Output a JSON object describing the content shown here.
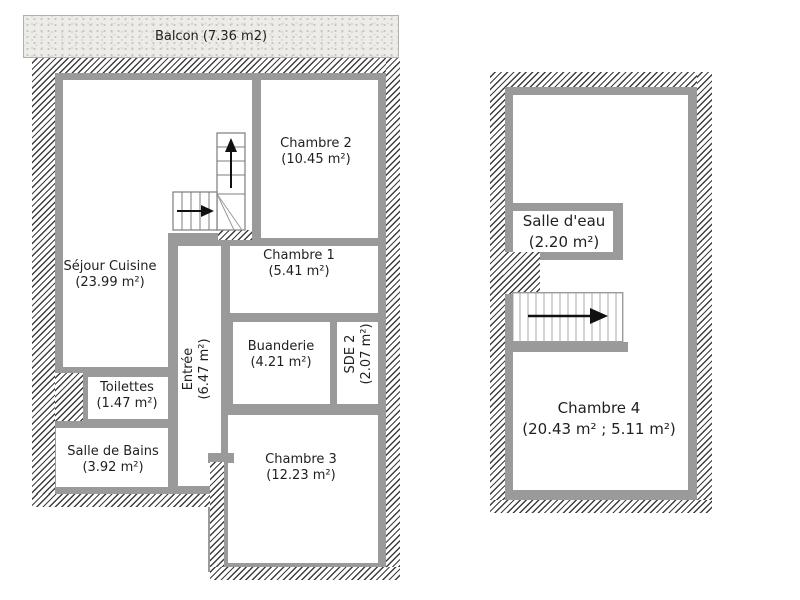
{
  "left_plan": {
    "balcony": {
      "label": "Balcon (7.36 m2)"
    },
    "rooms": {
      "sejour_cuisine": {
        "name": "Séjour Cuisine",
        "area": "(23.99 m²)"
      },
      "chambre2": {
        "name": "Chambre 2",
        "area": "(10.45 m²)"
      },
      "chambre1": {
        "name": "Chambre 1",
        "area": "(5.41 m²)"
      },
      "entree": {
        "name": "Entrée",
        "area": "(6.47 m²)"
      },
      "buanderie": {
        "name": "Buanderie",
        "area": "(4.21 m²)"
      },
      "sde2": {
        "name": "SDE 2",
        "area": "(2.07 m²)"
      },
      "toilettes": {
        "name": "Toilettes",
        "area": "(1.47 m²)"
      },
      "salle_de_bains": {
        "name": "Salle de Bains",
        "area": "(3.92 m²)"
      },
      "chambre3": {
        "name": "Chambre 3",
        "area": "(12.23 m²)"
      }
    }
  },
  "right_plan": {
    "rooms": {
      "salle_deau": {
        "name": "Salle d'eau",
        "area": "(2.20 m²)"
      },
      "chambre4": {
        "name": "Chambre 4",
        "area": "(20.43 m² ; 5.11 m²)"
      }
    }
  },
  "icons": {
    "stair_up_arrow": "↑",
    "stair_right_arrow": "→"
  },
  "colors": {
    "interior_wall": "#9a9a9a",
    "hatch_line": "#3e3e3e",
    "balcony_bg": "#edece8",
    "text": "#1f1f1f"
  }
}
